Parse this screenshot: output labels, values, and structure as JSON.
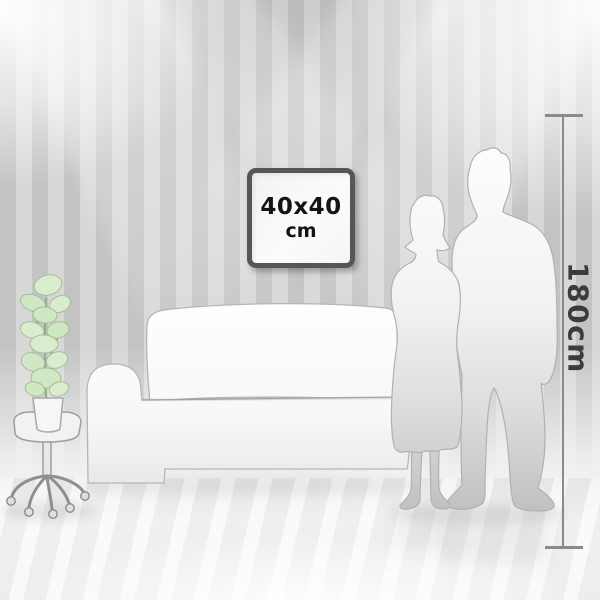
{
  "artwork": {
    "size_label": "40x40",
    "unit_label": "cm"
  },
  "ruler": {
    "label": "180cm"
  },
  "icons": [
    "picture-frame",
    "height-ruler",
    "couple-silhouette",
    "sofa-illustration",
    "plant-illustration",
    "stool-illustration"
  ],
  "colors": {
    "wall_stripe_dark": "#c3c3c3",
    "wall_stripe_light": "#d7d7d7",
    "floor": "#f1f1f1",
    "frame_border": "#565656",
    "frame_text": "#141414",
    "ruler": "#8a8a8a",
    "ruler_text": "#3b3b3b",
    "plant_green": "#d9ecce",
    "silhouette_light": "#f5f5f5",
    "silhouette_dark": "#c2c2c2"
  }
}
